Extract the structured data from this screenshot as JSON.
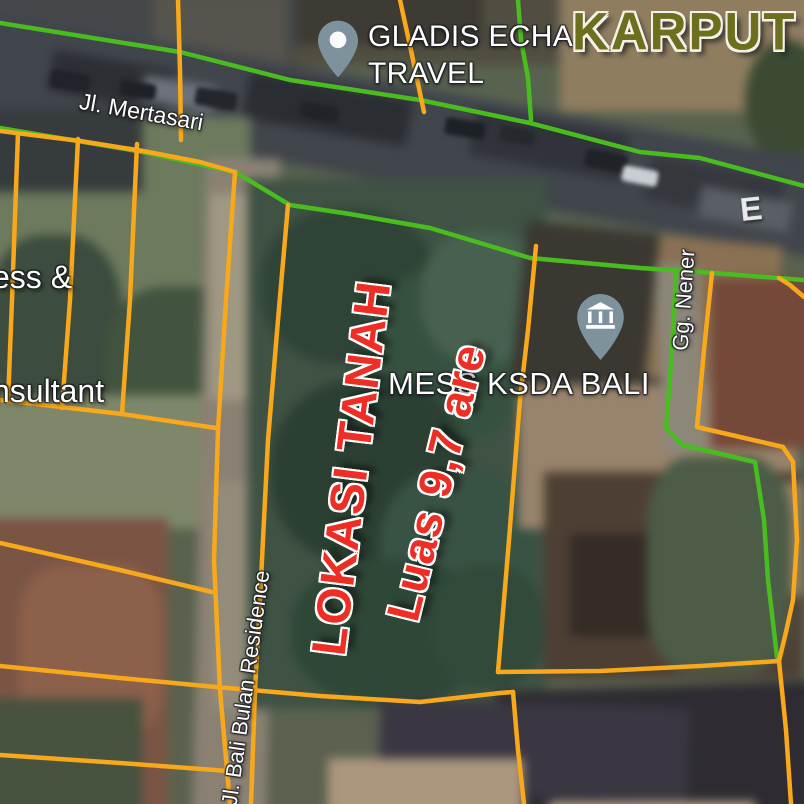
{
  "colors": {
    "parcel_line": "#f7a81b",
    "road_line": "#49bd1f",
    "annotation_red": "#ee2e24",
    "watermark_olive": "#6c6f1e",
    "pin_fill": "#7e929e",
    "label_white": "#ffffff"
  },
  "annotation": {
    "line1": "LOKASI TANAH",
    "line2": "Luas 9,7 are"
  },
  "watermarks": {
    "karput": "KARPUT",
    "left_fragment_line1": "ess &",
    "left_fragment_line2": "nsultant",
    "road_fragment": "E"
  },
  "places": [
    {
      "id": "gladis-echa-travel",
      "line1": "GLADIS ECHA",
      "line2": "TRAVEL"
    },
    {
      "id": "mess-ksda-bali",
      "label": "MESS KSDA BALI"
    }
  ],
  "roads": [
    {
      "id": "mertasari",
      "label": "Jl. Mertasari"
    },
    {
      "id": "gg-nener",
      "label": "Gg. Nener"
    },
    {
      "id": "bali-bulan",
      "label": "Jl. Bali Bulan Residence"
    }
  ]
}
